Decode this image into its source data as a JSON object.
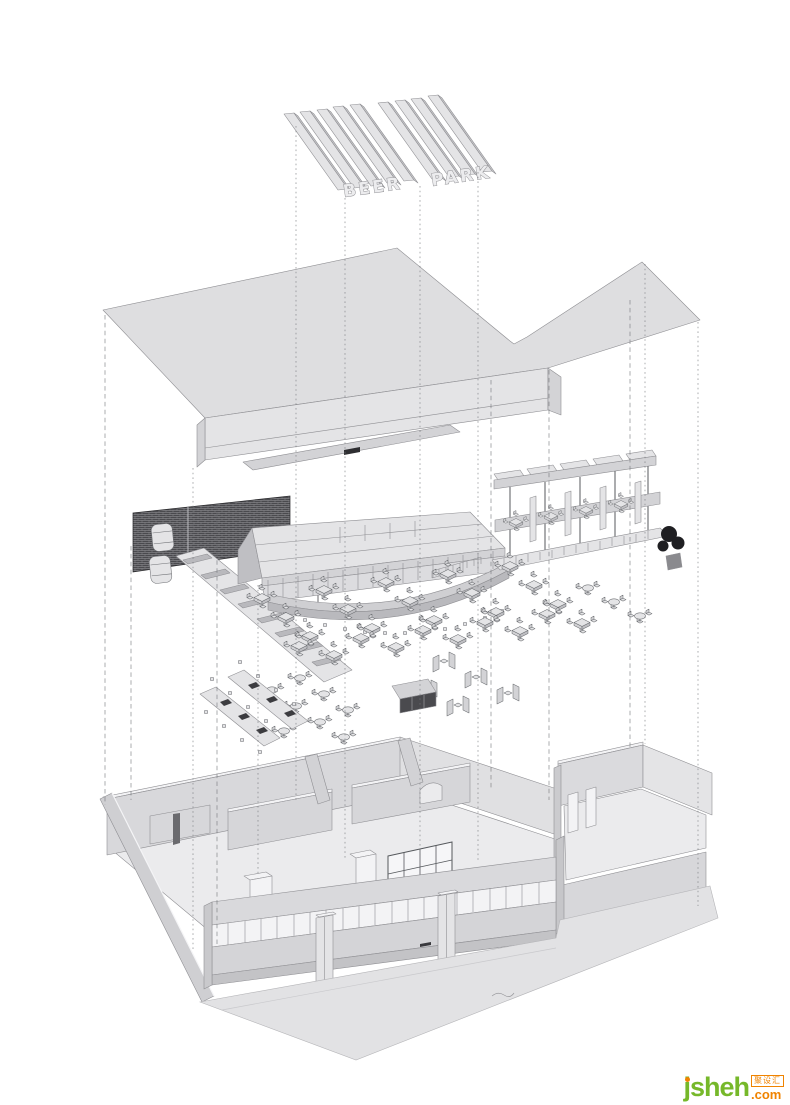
{
  "sign": {
    "text_left": "BEER",
    "text_right": "PARK"
  },
  "watermark": {
    "brand": "jsheh",
    "tld": ".com",
    "badge": "聚设汇"
  },
  "colors": {
    "background": "#ffffff",
    "line": "#6e7074",
    "fill_light": "#e4e4e6",
    "fill_mid": "#d3d3d6",
    "fill_dark": "#bfbfc3",
    "brick_wall": "#4a4a4e",
    "plant": "#1f1f22",
    "logo_green": "#76b82a",
    "logo_orange": "#f08300"
  }
}
